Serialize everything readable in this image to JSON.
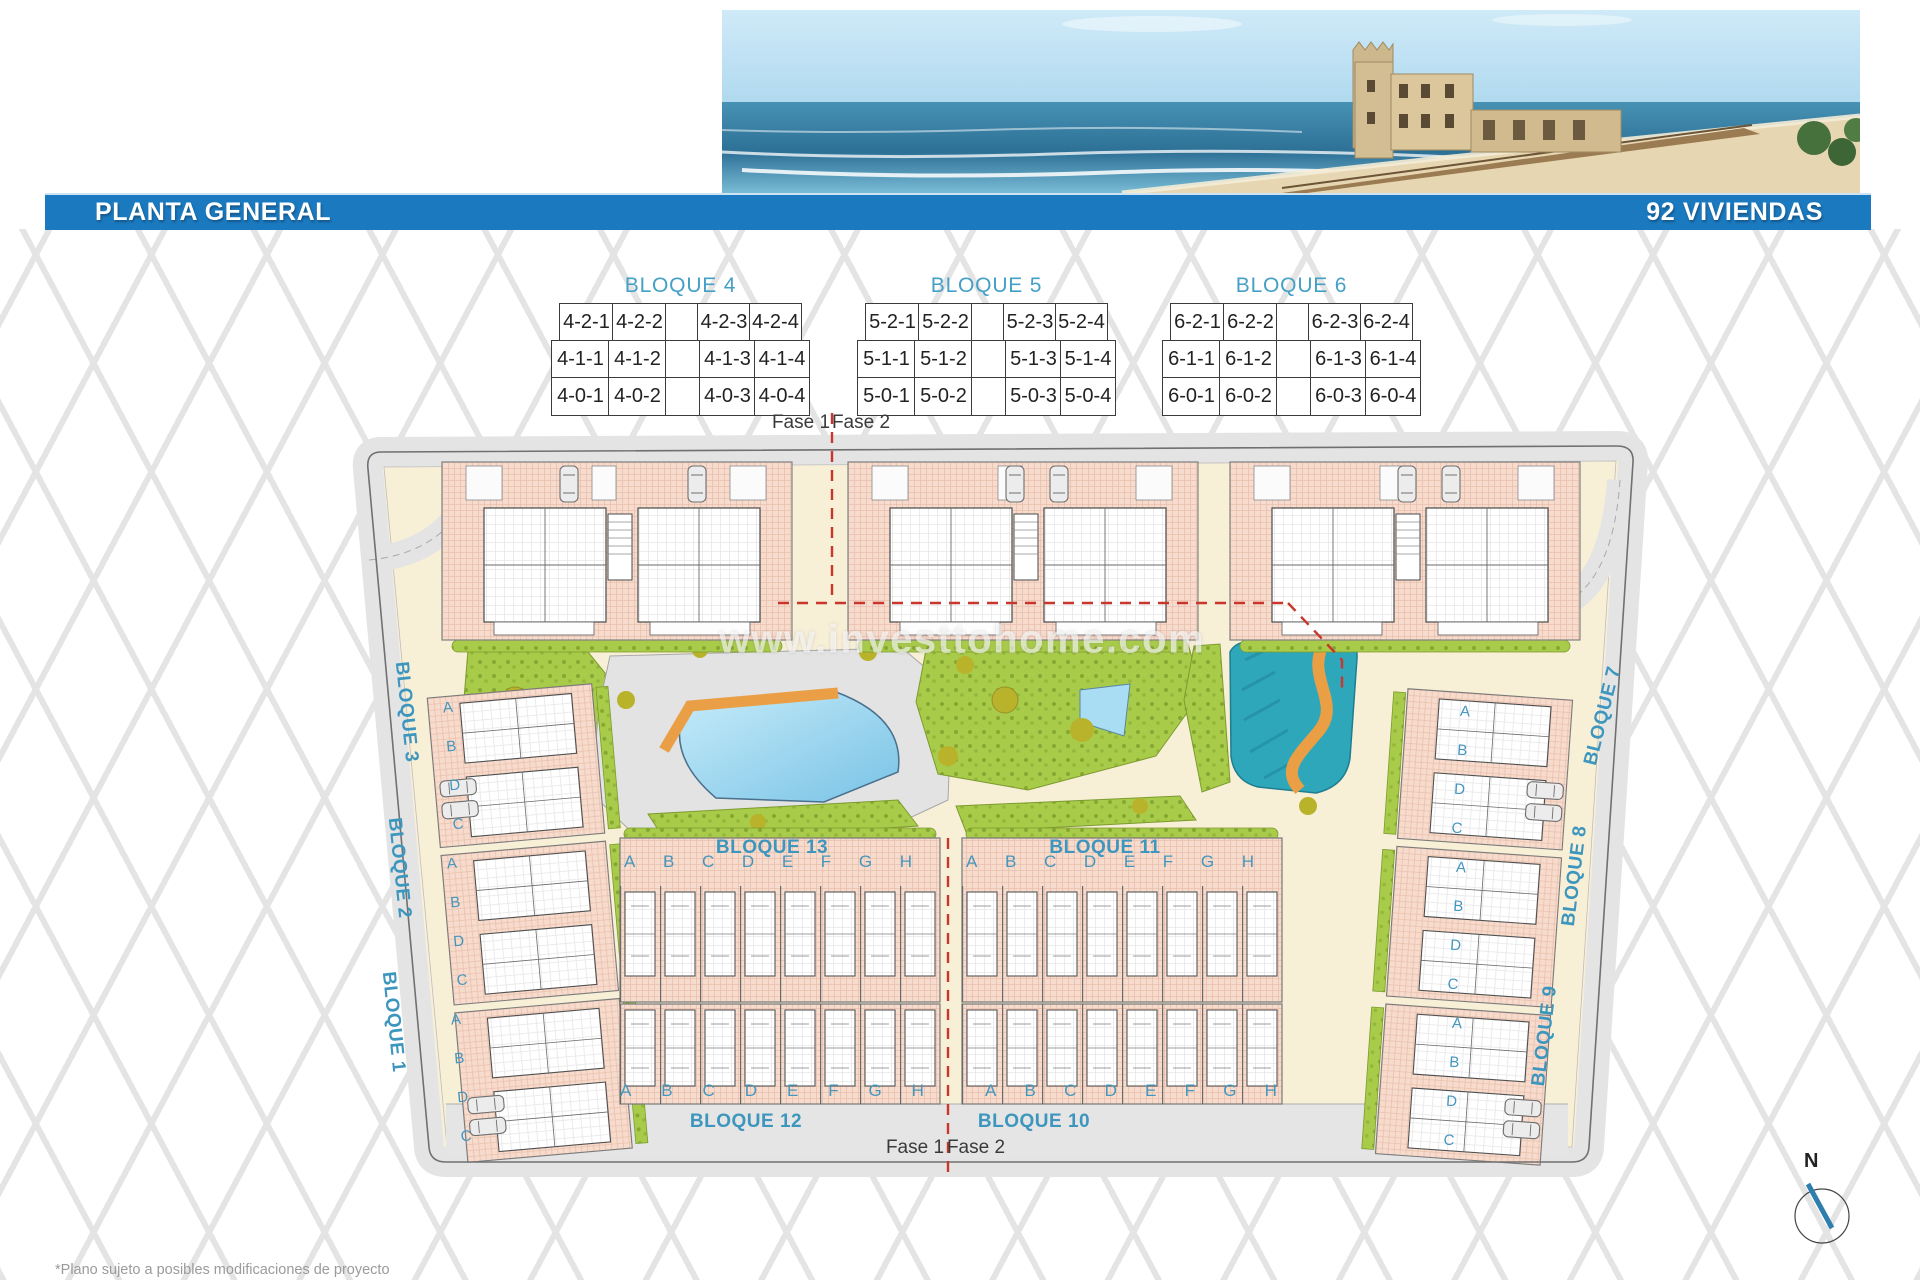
{
  "banner": {
    "title": "PLANTA GENERAL",
    "subtitle": "92 VIVIENDAS"
  },
  "tables": [
    {
      "title": "BLOQUE 4",
      "rows": [
        [
          "4-2-1",
          "4-2-2",
          "",
          "4-2-3",
          "4-2-4"
        ],
        [
          "4-1-1",
          "4-1-2",
          "",
          "4-1-3",
          "4-1-4"
        ],
        [
          "4-0-1",
          "4-0-2",
          "",
          "4-0-3",
          "4-0-4"
        ]
      ]
    },
    {
      "title": "BLOQUE 5",
      "rows": [
        [
          "5-2-1",
          "5-2-2",
          "",
          "5-2-3",
          "5-2-4"
        ],
        [
          "5-1-1",
          "5-1-2",
          "",
          "5-1-3",
          "5-1-4"
        ],
        [
          "5-0-1",
          "5-0-2",
          "",
          "5-0-3",
          "5-0-4"
        ]
      ]
    },
    {
      "title": "BLOQUE 6",
      "rows": [
        [
          "6-2-1",
          "6-2-2",
          "",
          "6-2-3",
          "6-2-4"
        ],
        [
          "6-1-1",
          "6-1-2",
          "",
          "6-1-3",
          "6-1-4"
        ],
        [
          "6-0-1",
          "6-0-2",
          "",
          "6-0-3",
          "6-0-4"
        ]
      ]
    }
  ],
  "plan": {
    "phase_top": {
      "left": "Fase 1",
      "right": "Fase 2"
    },
    "phase_bottom": {
      "left": "Fase 1",
      "right": "Fase 2"
    },
    "labels": {
      "b1": "BLOQUE 1",
      "b2": "BLOQUE 2",
      "b3": "BLOQUE 3",
      "b7": "BLOQUE 7",
      "b8": "BLOQUE 8",
      "b9": "BLOQUE 9",
      "b10": "BLOQUE 10",
      "b11": "BLOQUE 11",
      "b12": "BLOQUE 12",
      "b13": "BLOQUE 13"
    },
    "unit_letters": [
      "A",
      "B",
      "C",
      "D",
      "E",
      "F",
      "G",
      "H"
    ],
    "side_letters": [
      "A",
      "B",
      "D",
      "C"
    ],
    "watermark": "www.investtohome.com"
  },
  "compass": {
    "north": "N"
  },
  "footnote": "*Plano sujeto a posibles modificaciones de proyecto",
  "colors": {
    "banner_blue": "#1b7abf",
    "accent_teal": "#3d96bd",
    "phase_red": "#c9372c",
    "building_fill": "#f7dccd",
    "green": "#a9cb4a",
    "pool_blue": "#8fd0ec",
    "water_feature_teal": "#2fa7ba",
    "slide_orange": "#ea9f46"
  }
}
